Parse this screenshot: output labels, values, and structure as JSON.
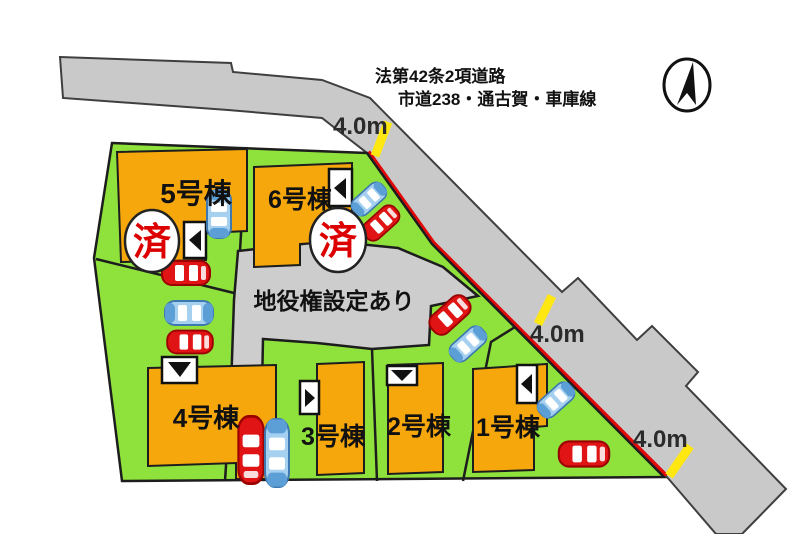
{
  "diagram": {
    "road": {
      "designation_line1": "法第42条2項道路",
      "designation_line2": "市道238・通古賀・車庫線",
      "width_labels": [
        "4.0m",
        "4.0m",
        "4.0m"
      ]
    },
    "easement_label": "地役権設定あり",
    "lots": [
      {
        "label": "1号棟",
        "sold": false
      },
      {
        "label": "2号棟",
        "sold": false
      },
      {
        "label": "3号棟",
        "sold": false
      },
      {
        "label": "4号棟",
        "sold": false
      },
      {
        "label": "5号棟",
        "sold": true,
        "sold_badge": "済"
      },
      {
        "label": "6号棟",
        "sold": true,
        "sold_badge": "済"
      }
    ],
    "colors": {
      "lot_green": "#8FE23C",
      "building_orange": "#F6A70B",
      "road_gray": "#C9C9C9",
      "easement_gray": "#CDCDCD",
      "frontage_red": "#E10808",
      "measure_yellow": "#FFE712",
      "sold_text_red": "#DC0000",
      "car_red": "#E01414",
      "car_blue": "#A5D0F0"
    }
  }
}
